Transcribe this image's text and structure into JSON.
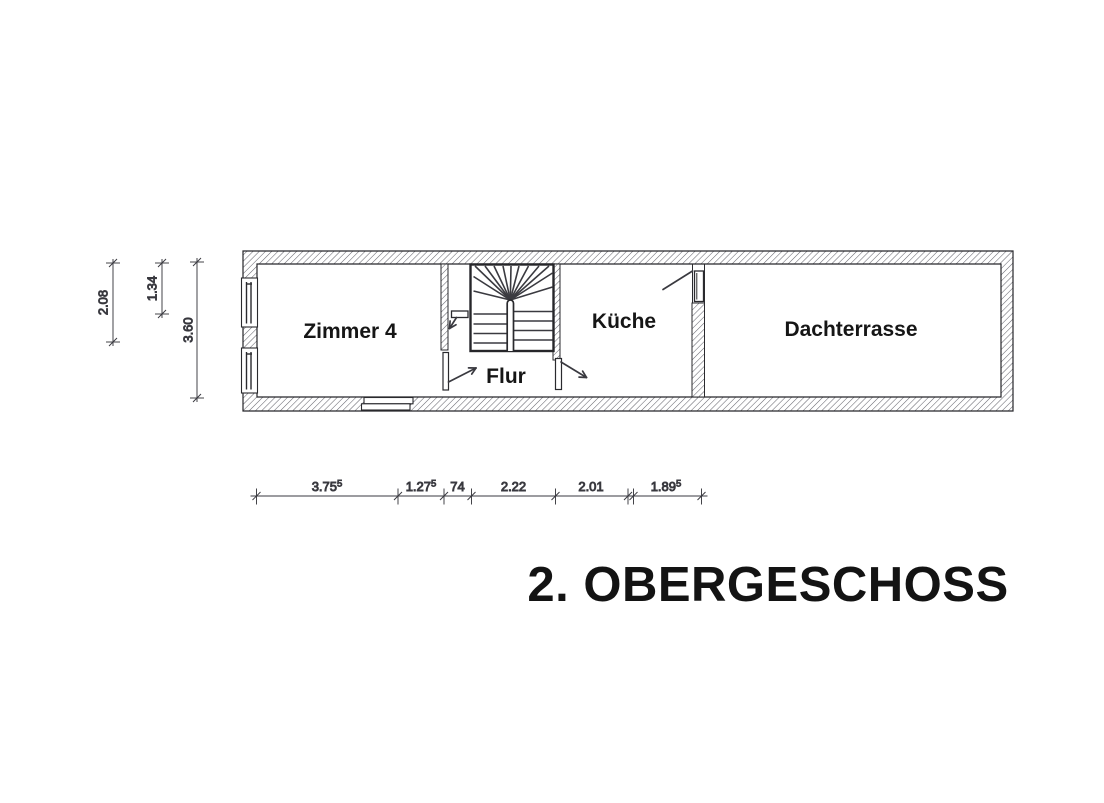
{
  "title": "2. OBERGESCHOSS",
  "rooms": [
    {
      "label": "Zimmer 4"
    },
    {
      "label": "Flur"
    },
    {
      "label": "Küche"
    },
    {
      "label": "Dachterrasse"
    }
  ],
  "dimensions": {
    "bottom": [
      {
        "value": "3.75",
        "sup": "5"
      },
      {
        "value": "1.27",
        "sup": "5"
      },
      {
        "value": "74"
      },
      {
        "value": "2.22"
      },
      {
        "value": "2.01"
      },
      {
        "value": "1.89",
        "sup": "5"
      }
    ],
    "left": [
      {
        "value": "2.08"
      },
      {
        "value": "1.34"
      },
      {
        "value": "3.60"
      }
    ]
  },
  "colors": {
    "paper": "#ffffff",
    "line": "#26262a",
    "hatch": "#60606a",
    "text": "#161616"
  }
}
